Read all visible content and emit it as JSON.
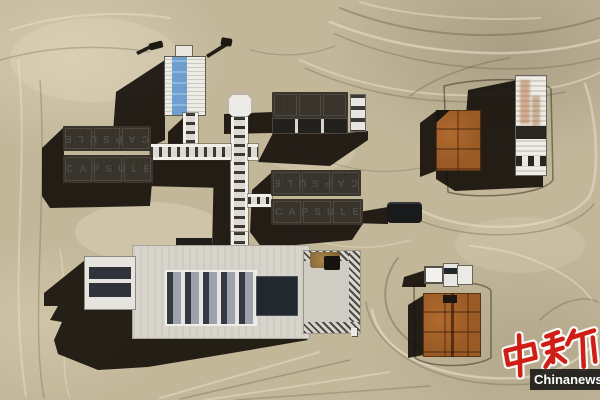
{
  "modules": {
    "west_top_label": "CAPSULE",
    "west_bottom_label": "CAPSULE",
    "east_top_label": "CAPSULE",
    "east_bottom_label": "CAPSULE"
  },
  "watermark": {
    "logo_text": "中新",
    "site_text": "Chinanews.com"
  },
  "colors": {
    "sand": "#c3b79a",
    "sand_light": "#d8cdb0",
    "sand_dark": "#a3987c",
    "shadow": "#120d08",
    "module_white": "#eae8e2",
    "module_frame": "#39342c",
    "roof_blue": "#6f9fce",
    "rust": "#9a5a26",
    "watermark_red": "#cf1e15",
    "news_bar_black": "#0a0a0a"
  }
}
